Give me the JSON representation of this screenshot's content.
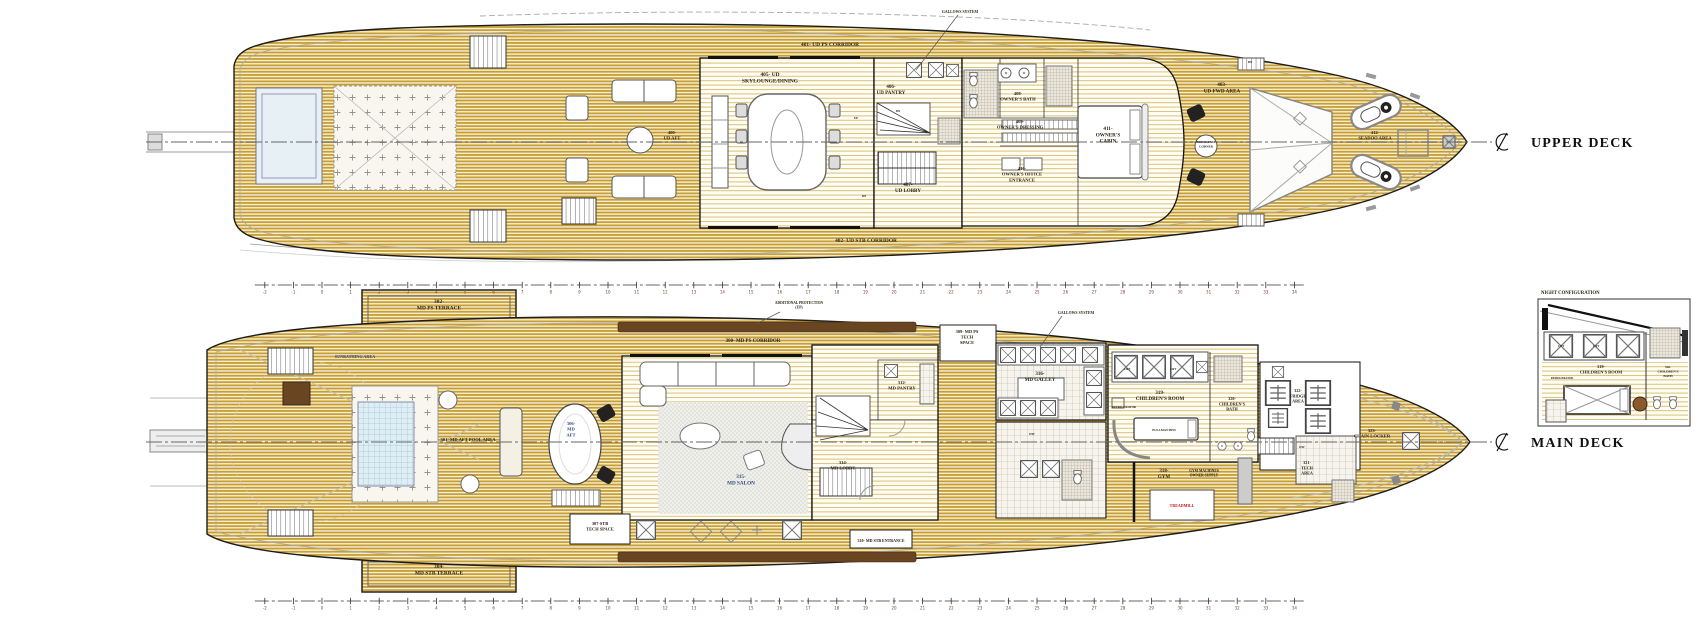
{
  "colors": {
    "deck_wood": "#c49b2f",
    "hull_outline": "#1c1c1c",
    "pool": "#d9edf4",
    "caprail_brown": "#6a4522",
    "label_ink": "#2a2312",
    "label_blue": "#2f4a7d",
    "label_red": "#c01818",
    "ruler_ink": "#7e3b28"
  },
  "upper_deck": {
    "title": "UPPER DECK",
    "rooms": [
      {
        "name": "ud-aft-label",
        "lines": [
          "400-",
          "UD AFT"
        ],
        "x": 672,
        "y": 134,
        "size": 4.6
      },
      {
        "name": "ud-ps-corridor-label",
        "lines": [
          "401- UD PS CORRIDOR"
        ],
        "x": 830,
        "y": 46,
        "size": 5.4
      },
      {
        "name": "ud-stb-corridor-label",
        "lines": [
          "402- UD STB CORRIDOR"
        ],
        "x": 866,
        "y": 242,
        "size": 5.4
      },
      {
        "name": "ud-fwd-area-label",
        "lines": [
          "403-",
          "UD FWD AREA"
        ],
        "x": 1222,
        "y": 86,
        "size": 5.2
      },
      {
        "name": "ud-skylounge-label",
        "lines": [
          "405- UD",
          "SKYLOUNGE/DINING"
        ],
        "x": 770,
        "y": 76,
        "size": 5.4
      },
      {
        "name": "ud-pantry-label",
        "lines": [
          "406-",
          "UD PANTRY"
        ],
        "x": 891,
        "y": 88,
        "size": 5
      },
      {
        "name": "ud-lobby-label",
        "lines": [
          "407-",
          "UD LOBBY"
        ],
        "x": 908,
        "y": 186,
        "size": 5
      },
      {
        "name": "owners-bath-label",
        "lines": [
          "408-",
          "OWNER'S BATH"
        ],
        "x": 1018,
        "y": 95,
        "size": 4.6
      },
      {
        "name": "owners-dressing-label",
        "lines": [
          "409-",
          "OWNER'S DRESSING"
        ],
        "x": 1020,
        "y": 123,
        "size": 4.6
      },
      {
        "name": "owners-office-label",
        "lines": [
          "410-",
          "OWNER'S OFFICE",
          "ENTRANCE"
        ],
        "x": 1022,
        "y": 170,
        "size": 4.6
      },
      {
        "name": "owners-cabin-label",
        "lines": [
          "411-",
          "OWNER'S",
          "CABIN"
        ],
        "x": 1108,
        "y": 130,
        "size": 5.2
      },
      {
        "name": "breakfast-label",
        "lines": [
          "BREAKFAST",
          "CORNER"
        ],
        "x": 1206,
        "y": 143,
        "size": 3.2
      },
      {
        "name": "seadoo-label",
        "lines": [
          "412-",
          "SEADOO AREA"
        ],
        "x": 1375,
        "y": 134,
        "size": 4.6
      }
    ]
  },
  "main_deck": {
    "title": "MAIN DECK",
    "rooms": [
      {
        "name": "md-ps-terrace-label",
        "lines": [
          "302-",
          "MD PS TERRACE"
        ],
        "x": 439,
        "y": 303,
        "size": 5.4
      },
      {
        "name": "md-stb-terrace-label",
        "lines": [
          "304-",
          "MD STB TERRACE"
        ],
        "x": 439,
        "y": 568,
        "size": 5.4
      },
      {
        "name": "md-ps-corridor-label",
        "lines": [
          "300- MD PS CORRIDOR"
        ],
        "x": 753,
        "y": 342,
        "size": 5
      },
      {
        "name": "sunbathing-label",
        "lines": [
          "SUNBATHING AREA"
        ],
        "x": 355,
        "y": 358,
        "size": 4.2,
        "color": "#2f4a7d"
      },
      {
        "name": "md-aft-pool-label",
        "lines": [
          "301- MD AFT POOL AREA"
        ],
        "x": 468,
        "y": 441,
        "size": 4.6
      },
      {
        "name": "md-aft-label",
        "lines": [
          "306-",
          "MD",
          "AFT"
        ],
        "x": 571,
        "y": 425,
        "size": 4.6,
        "color": "#2f4a7d"
      },
      {
        "name": "md-salon-label",
        "lines": [
          "315-",
          "MD SALON"
        ],
        "x": 741,
        "y": 478,
        "size": 5.2,
        "color": "#2f4a7d"
      },
      {
        "name": "stb-tech-space-label",
        "lines": [
          "307-STB",
          "TECH SPACE"
        ],
        "x": 600,
        "y": 525,
        "size": 4.4
      },
      {
        "name": "md-stb-entrance-label",
        "lines": [
          "310- MD STB ENTRANCE"
        ],
        "x": 881,
        "y": 542,
        "size": 4
      },
      {
        "name": "md-pantry-label",
        "lines": [
          "312-",
          "MD PANTRY"
        ],
        "x": 902,
        "y": 384,
        "size": 4.6
      },
      {
        "name": "md-lobby-label",
        "lines": [
          "314-",
          "MD LOBBY"
        ],
        "x": 843,
        "y": 464,
        "size": 4.6
      },
      {
        "name": "md-ps-tech-label",
        "lines": [
          "309- MD PS",
          "TECH",
          "SPACE"
        ],
        "x": 967,
        "y": 333,
        "size": 4.4
      },
      {
        "name": "md-galley-label",
        "lines": [
          "316-",
          "MD GALLEY"
        ],
        "x": 1040,
        "y": 375,
        "size": 5
      },
      {
        "name": "childrens-room-label",
        "lines": [
          "319-",
          "CHILDREN'S ROOM"
        ],
        "x": 1160,
        "y": 394,
        "size": 5
      },
      {
        "name": "childrens-bath-label",
        "lines": [
          "320-",
          "CHILDREN'S",
          "BATH"
        ],
        "x": 1232,
        "y": 400,
        "size": 4.2
      },
      {
        "name": "fridge-area-label",
        "lines": [
          "322-",
          "FRIDGE",
          "AREA"
        ],
        "x": 1298,
        "y": 392,
        "size": 4.2
      },
      {
        "name": "gym-label",
        "lines": [
          "318-",
          "GYM"
        ],
        "x": 1164,
        "y": 472,
        "size": 5
      },
      {
        "name": "gym-note-label",
        "lines": [
          "GYM MACHINES",
          "OWNER SUPPLY"
        ],
        "x": 1204,
        "y": 472,
        "size": 3.6
      },
      {
        "name": "tech-area-label",
        "lines": [
          "321-",
          "TECH",
          "AREA"
        ],
        "x": 1307,
        "y": 464,
        "size": 4.2
      },
      {
        "name": "chain-locker-label",
        "lines": [
          "323-",
          "CHAIN LOCKER"
        ],
        "x": 1372,
        "y": 432,
        "size": 4.6
      },
      {
        "name": "pullman-bed-label",
        "lines": [
          "PULLMAN BED"
        ],
        "x": 1164,
        "y": 431,
        "size": 3.2
      },
      {
        "name": "treadmill-label",
        "lines": [
          "TREADMILL"
        ],
        "x": 1182,
        "y": 507,
        "size": 4,
        "color": "#c01818"
      },
      {
        "name": "refrigerator-label",
        "lines": [
          "REFRIGERATOR"
        ],
        "x": 1124,
        "y": 408,
        "size": 3
      }
    ]
  },
  "inset": {
    "title": "NIGHT CONFIGURATION",
    "labels": [
      {
        "name": "night-childrens-room-label",
        "lines": [
          "319-",
          "CHILDREN'S ROOM"
        ],
        "x": 1601,
        "y": 368,
        "size": 4.4
      },
      {
        "name": "night-childrens-bath-label",
        "lines": [
          "320-",
          "CHILDREN'S",
          "BATH"
        ],
        "x": 1668,
        "y": 368,
        "size": 3.4
      },
      {
        "name": "night-lift-label-1",
        "lines": [
          "LIFT"
        ],
        "x": 1561,
        "y": 347,
        "size": 2.8
      },
      {
        "name": "night-lift-label-2",
        "lines": [
          "LIFT"
        ],
        "x": 1596,
        "y": 347,
        "size": 2.8
      },
      {
        "name": "night-refrigerator-label",
        "lines": [
          "REFRIGERATOR"
        ],
        "x": 1562,
        "y": 379,
        "size": 2.8
      }
    ]
  },
  "annotations": [
    {
      "name": "ud-gallows-annotation",
      "lines": [
        "GALLOWS SYSTEM"
      ],
      "x": 960,
      "y": 13,
      "size": 3.8,
      "leader": [
        [
          958,
          15
        ],
        [
          916,
          70
        ]
      ]
    },
    {
      "name": "md-gallows-annotation",
      "lines": [
        "GALLOWS SYSTEM"
      ],
      "x": 1076,
      "y": 314,
      "size": 3.8,
      "leader": [
        [
          1062,
          316
        ],
        [
          1040,
          347
        ]
      ]
    },
    {
      "name": "md-protection-annotation",
      "lines": [
        "ADDITIONAL PROTECTION",
        "(UP)"
      ],
      "x": 799,
      "y": 304,
      "size": 3.6,
      "leader": [
        [
          780,
          312
        ],
        [
          756,
          324
        ]
      ]
    }
  ],
  "misc_labels": [
    {
      "name": "stair-up-label",
      "lines": [
        "UP"
      ],
      "x": 856,
      "y": 119,
      "size": 3.2
    },
    {
      "name": "stair-dn-label-1",
      "lines": [
        "DN"
      ],
      "x": 898,
      "y": 112,
      "size": 3.2
    },
    {
      "name": "stair-dn-label-2",
      "lines": [
        "DN"
      ],
      "x": 864,
      "y": 197,
      "size": 3.2
    },
    {
      "name": "stair-dn-label-3",
      "lines": [
        "DN"
      ],
      "x": 1250,
      "y": 63,
      "size": 3.2
    },
    {
      "name": "stair-dw-label-1",
      "lines": [
        "DW"
      ],
      "x": 1302,
      "y": 448,
      "size": 3.2
    },
    {
      "name": "stair-dw-label-2",
      "lines": [
        "DW"
      ],
      "x": 1032,
      "y": 435,
      "size": 3.2
    },
    {
      "name": "lift-label-1",
      "lines": [
        "LIFT"
      ],
      "x": 1127,
      "y": 370,
      "size": 2.8
    },
    {
      "name": "lift-label-2",
      "lines": [
        "LIFT"
      ],
      "x": 1173,
      "y": 370,
      "size": 2.8
    }
  ],
  "rulers": [
    {
      "name": "upper-ruler",
      "y": 285,
      "from": -2,
      "to": 34,
      "x0": 322,
      "px_per_unit": 28.6
    },
    {
      "name": "lower-ruler",
      "y": 601,
      "from": -2,
      "to": 34,
      "x0": 322,
      "px_per_unit": 28.6
    }
  ]
}
